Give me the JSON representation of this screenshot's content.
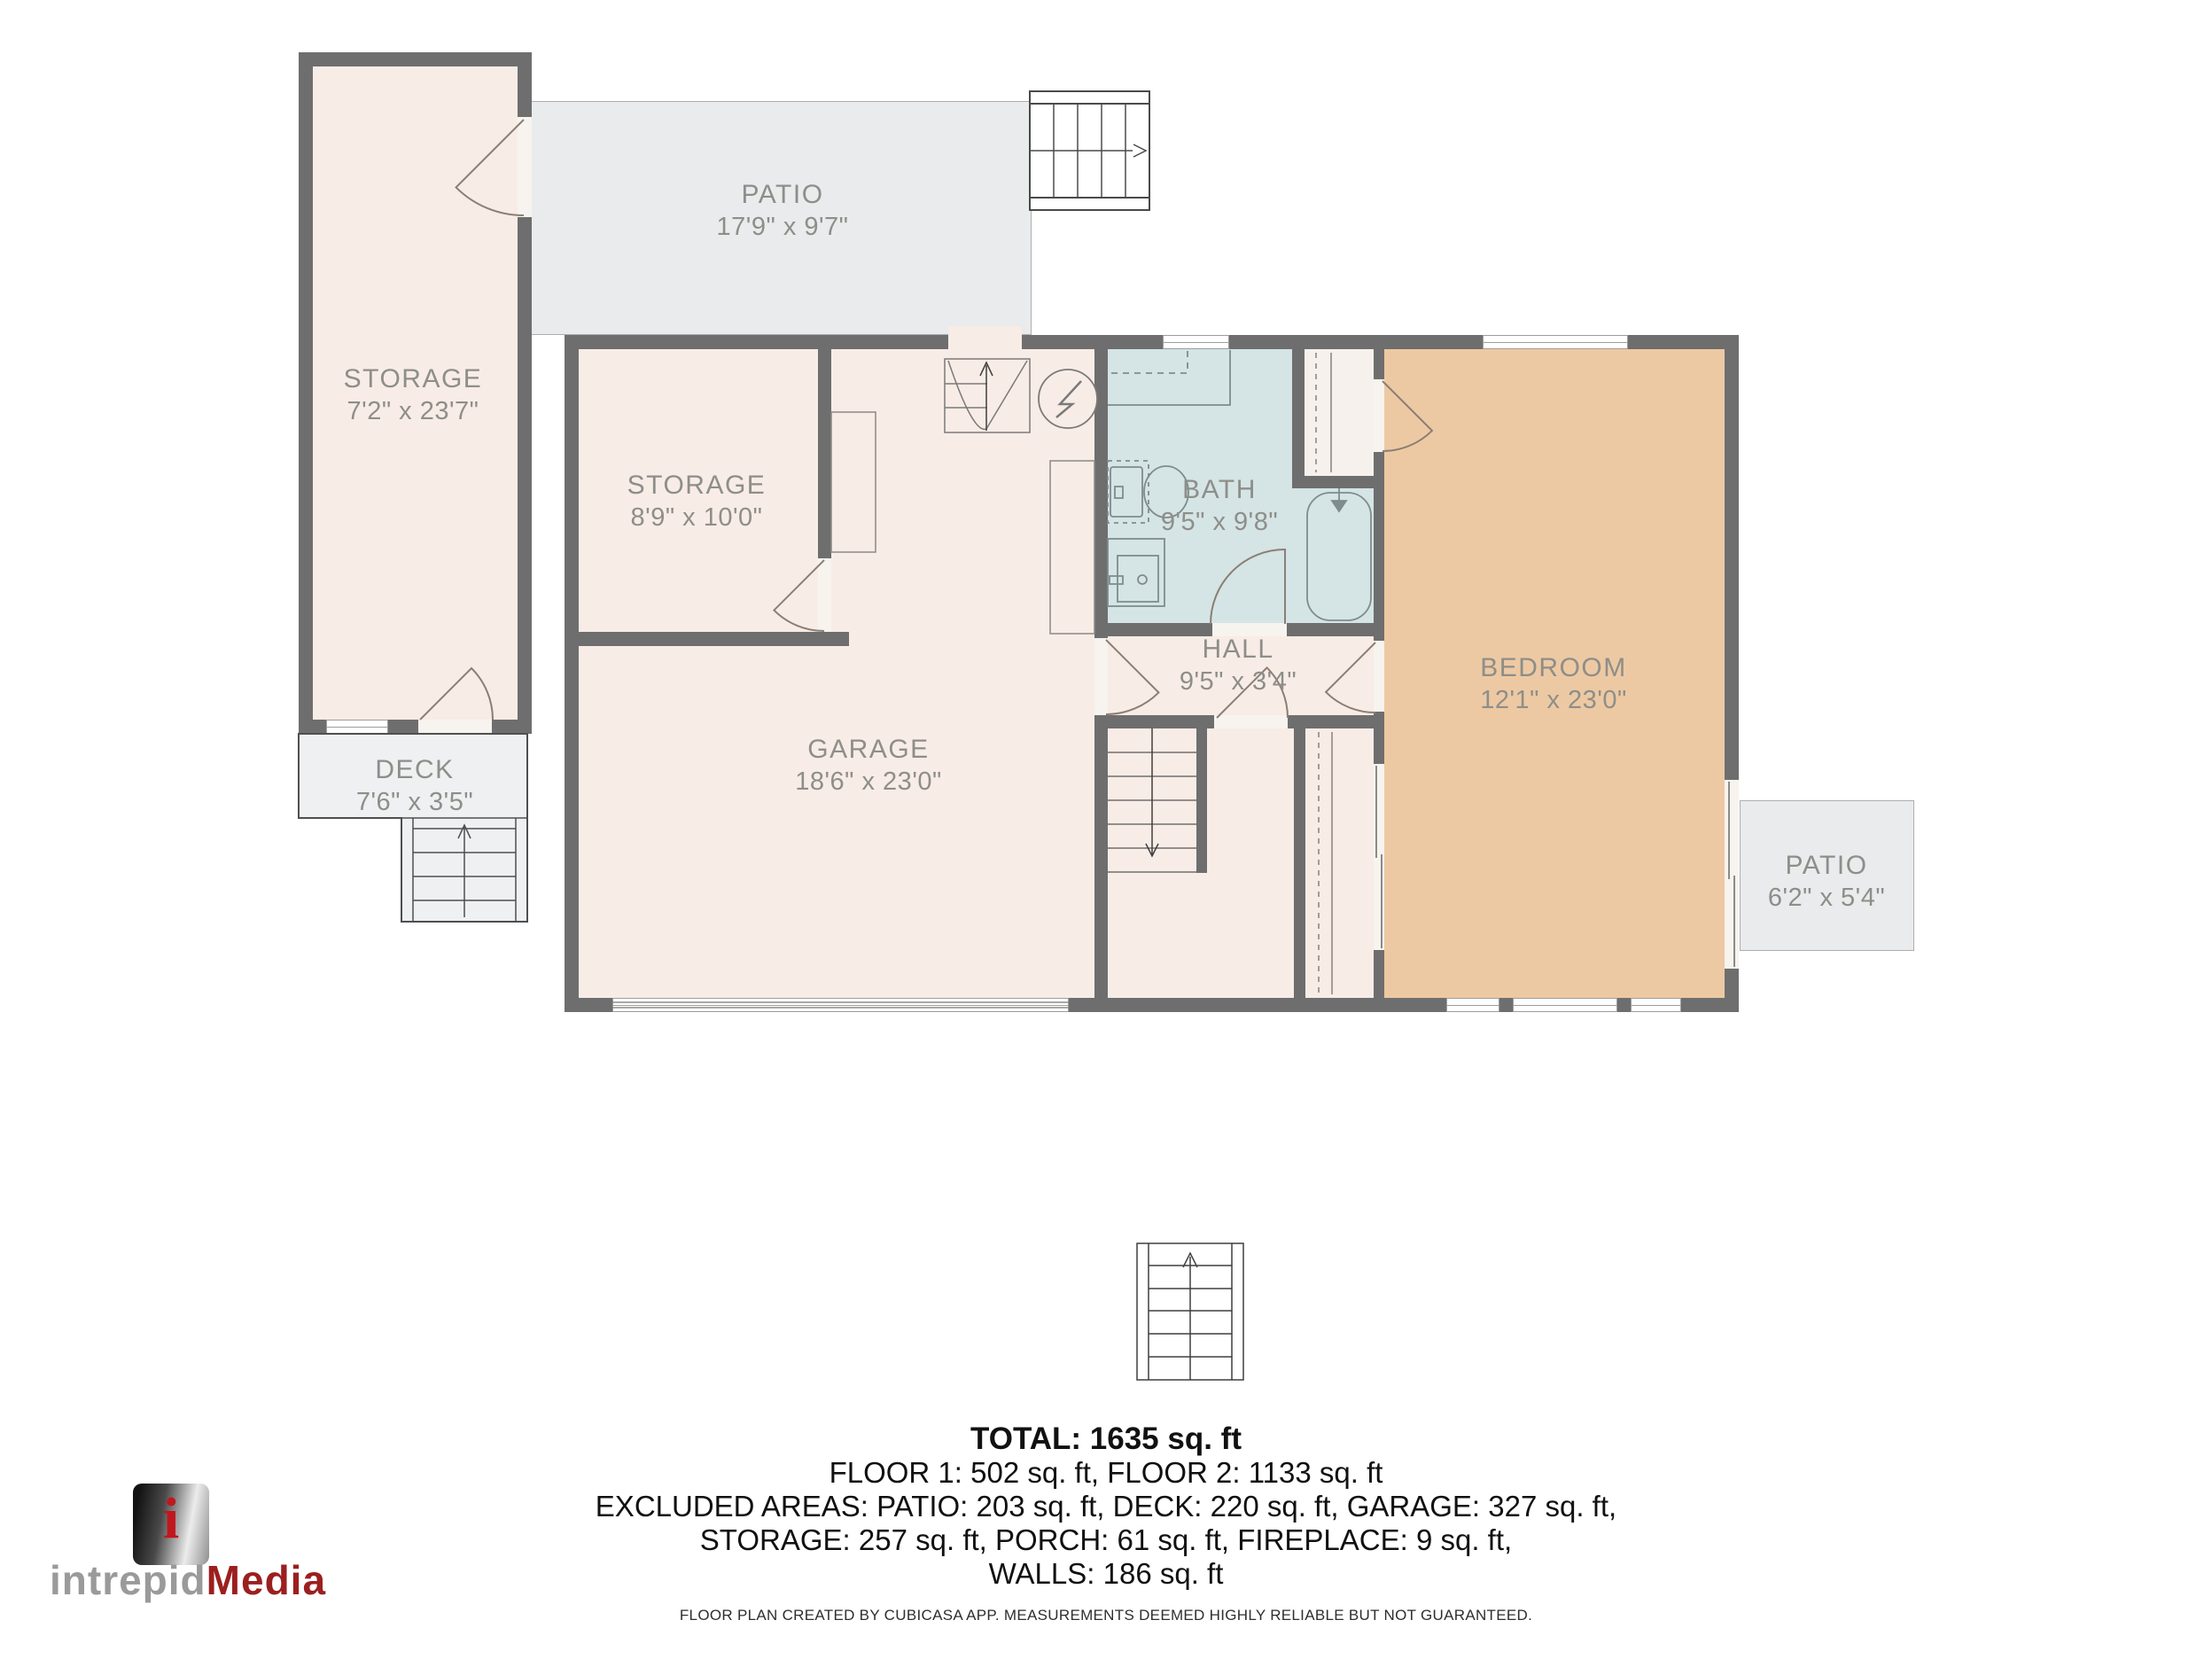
{
  "rooms": [
    {
      "id": "storage-tall",
      "name": "STORAGE",
      "dims": "7'2\" x 23'7\""
    },
    {
      "id": "patio-top",
      "name": "PATIO",
      "dims": "17'9\" x 9'7\""
    },
    {
      "id": "storage-inner",
      "name": "STORAGE",
      "dims": "8'9\" x 10'0\""
    },
    {
      "id": "garage",
      "name": "GARAGE",
      "dims": "18'6\" x 23'0\""
    },
    {
      "id": "bath",
      "name": "BATH",
      "dims": "9'5\" x 9'8\""
    },
    {
      "id": "hall",
      "name": "HALL",
      "dims": "9'5\" x 3'4\""
    },
    {
      "id": "bedroom",
      "name": "BEDROOM",
      "dims": "12'1\" x 23'0\""
    },
    {
      "id": "patio-right",
      "name": "PATIO",
      "dims": "6'2\" x 5'4\""
    },
    {
      "id": "deck",
      "name": "DECK",
      "dims": "7'6\" x 3'5\""
    }
  ],
  "summary": {
    "total": "TOTAL: 1635 sq. ft",
    "floors": "FLOOR 1: 502 sq. ft, FLOOR 2: 1133 sq. ft",
    "excluded_line1": "EXCLUDED AREAS: PATIO: 203 sq. ft, DECK: 220 sq. ft, GARAGE: 327 sq. ft,",
    "excluded_line2": "STORAGE: 257 sq. ft, PORCH: 61 sq. ft, FIREPLACE: 9 sq. ft,",
    "walls": "WALLS: 186 sq. ft"
  },
  "disclaimer": "FLOOR PLAN CREATED BY CUBICASA APP. MEASUREMENTS DEEMED HIGHLY RELIABLE BUT NOT GUARANTEED.",
  "logo": {
    "brand_gray": "intrepid",
    "brand_red": "Media",
    "cube_letter": "i"
  },
  "colors": {
    "wall": "#6e6e6e",
    "floor": "#f8ece6",
    "bath": "#d5e4e5",
    "bedroom": "#edc9a3",
    "patio": "#e9ebec",
    "deck": "#eef0f1",
    "closet": "#f6f1ec",
    "line": "#8b7f74",
    "label": "#8e8e89",
    "logo-red": "#9c1f1f",
    "logo-gray": "#9a9a9a"
  }
}
